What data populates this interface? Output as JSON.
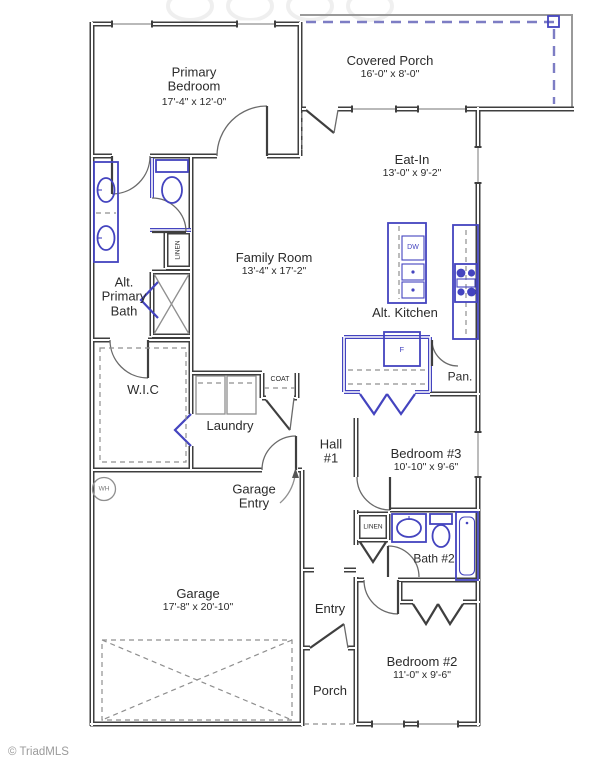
{
  "rooms": {
    "primary_bedroom": {
      "name": "Primary Bedroom",
      "dims": "17'-4\" x 12'-0\""
    },
    "covered_porch": {
      "name": "Covered Porch",
      "dims": "16'-0\" x 8'-0\""
    },
    "eat_in": {
      "name": "Eat-In",
      "dims": "13'-0\" x 9'-2\""
    },
    "family_room": {
      "name": "Family Room",
      "dims": "13'-4\" x 17'-2\""
    },
    "alt_kitchen": {
      "name": "Alt. Kitchen"
    },
    "alt_primary_bath": {
      "name": "Alt. Primary Bath"
    },
    "wic": {
      "name": "W.I.C"
    },
    "laundry": {
      "name": "Laundry"
    },
    "hall_1": {
      "name": "Hall #1"
    },
    "garage_entry": {
      "name": "Garage Entry"
    },
    "bedroom_3": {
      "name": "Bedroom #3",
      "dims": "10'-10\" x 9'-6\""
    },
    "pantry": {
      "name": "Pan."
    },
    "bath_2": {
      "name": "Bath #2"
    },
    "garage": {
      "name": "Garage",
      "dims": "17'-8\" x 20'-10\""
    },
    "entry": {
      "name": "Entry"
    },
    "porch": {
      "name": "Porch"
    },
    "bedroom_2": {
      "name": "Bedroom #2",
      "dims": "11'-0\" x 9'-6\""
    }
  },
  "fixtures": {
    "linen_primary": {
      "label": "LINEN"
    },
    "linen_hall": {
      "label": "LINEN"
    },
    "coat": {
      "label": "COAT"
    },
    "water_heater": {
      "label": "WH"
    },
    "dishwasher": {
      "label": "DW"
    },
    "refrigerator": {
      "label": "F"
    }
  },
  "footer": {
    "copyright": "© TriadMLS"
  },
  "colors": {
    "wall": "#3f3f3f",
    "fixture_blue": "#4444bf",
    "porch_dash_blue": "#7d7dc4",
    "line_gray": "#8f8f8f",
    "text": "#2b2b2b"
  }
}
